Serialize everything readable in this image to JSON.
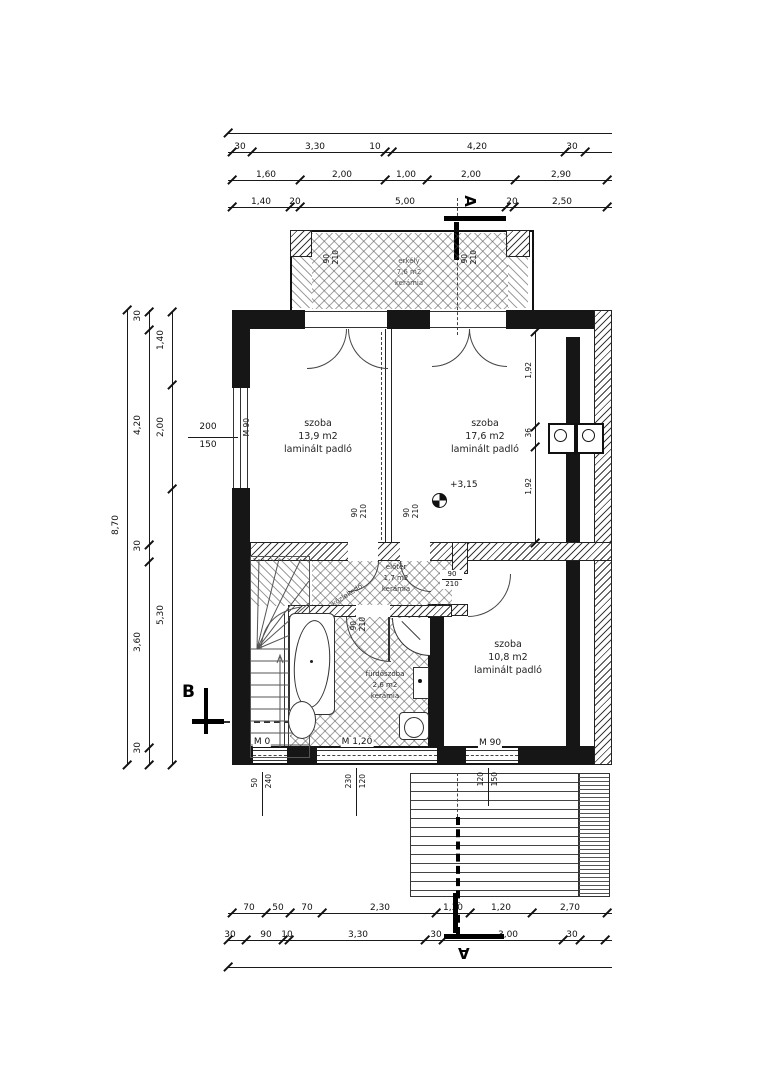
{
  "rooms": {
    "erkely": {
      "name": "erkély",
      "area": "7,6 m2",
      "finish": "kerámia"
    },
    "szoba_bl": {
      "name": "szoba",
      "area": "13,9 m2",
      "finish": "laminált padló"
    },
    "szoba_br": {
      "name": "szoba",
      "area": "17,6 m2",
      "finish": "laminált padló"
    },
    "szoba_s": {
      "name": "szoba",
      "area": "10,8 m2",
      "finish": "laminált padló"
    },
    "furdo": {
      "name": "fürdőszoba",
      "area": "2,6 m2",
      "finish": "kerámia"
    },
    "eloter": {
      "name": "előtér",
      "area": "1,7 m2",
      "finish": "kerámia"
    },
    "kozlekedo": {
      "name": "közlekedő"
    }
  },
  "level_marker": "+3,15",
  "sections": {
    "a": "A",
    "b": "B"
  },
  "door": {
    "w": "90",
    "h": "210"
  },
  "windows": {
    "left": {
      "w": "200",
      "h": "150",
      "sill": "M 90"
    },
    "b_left": {
      "w": "50",
      "h": "240",
      "sill": "M 0"
    },
    "b_mid": {
      "w": "230",
      "h": "120",
      "sill": "M 1,20"
    },
    "b_right": {
      "w": "120",
      "h": "150",
      "sill": "M 90"
    }
  },
  "dims": {
    "top1": [
      "30",
      "3,30",
      "10",
      "4,20",
      "30"
    ],
    "top2": [
      "1,60",
      "2,00",
      "1,00",
      "2,00",
      "2,90"
    ],
    "top3": [
      "1,40",
      "20",
      "5,00",
      "20",
      "2,50"
    ],
    "bottom1": [
      "70",
      "50",
      "70",
      "2,30",
      "1,30",
      "1,20",
      "2,70"
    ],
    "bottom2": [
      "30",
      "90",
      "10",
      "3,30",
      "30",
      "3,00",
      "30"
    ],
    "left_total": "8,70",
    "left_outer": [
      "30",
      "4,20",
      "30",
      "3,60",
      "30"
    ],
    "left_inner": [
      "1,40",
      "2,00",
      "5,30"
    ],
    "right_chain": [
      "1,92",
      "36",
      "1,92"
    ]
  }
}
